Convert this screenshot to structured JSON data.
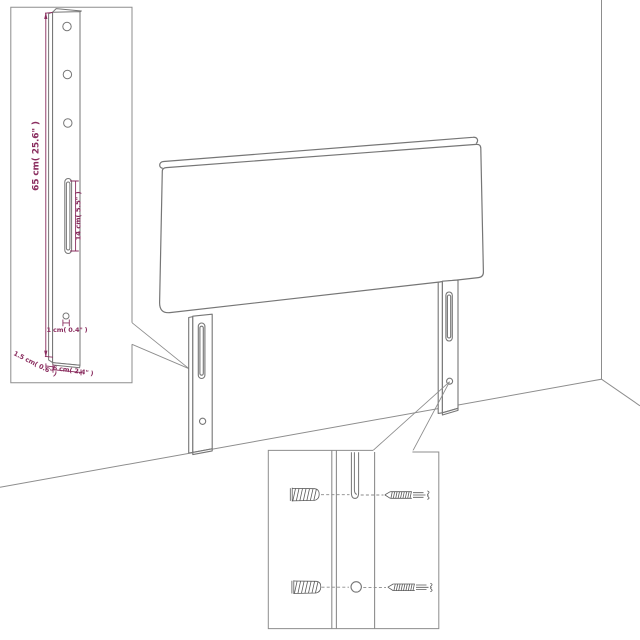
{
  "palette": {
    "background": "#ffffff",
    "outline": "#7a7a7a",
    "room_line": "#8d8d8d",
    "hardware_line": "#5a5a5a",
    "dimension": "#8a2d5f"
  },
  "detail_top_left": {
    "hole_count": 3,
    "labels": {
      "leg_height": "65 cm( 25.6\" )",
      "slot_length": "14 cm( 5.5\" )",
      "hole_diameter": "1 cm( 0.4\" )",
      "leg_depth": "1.5 cm( 0.6\" )",
      "leg_width": "6 cm( 2.4\" )"
    }
  },
  "detail_bottom": {
    "icons": [
      "wall-plug-icon",
      "screw-icon",
      "wall-plug-icon",
      "screw-icon"
    ],
    "hole_count": 1,
    "slot_count": 1
  }
}
